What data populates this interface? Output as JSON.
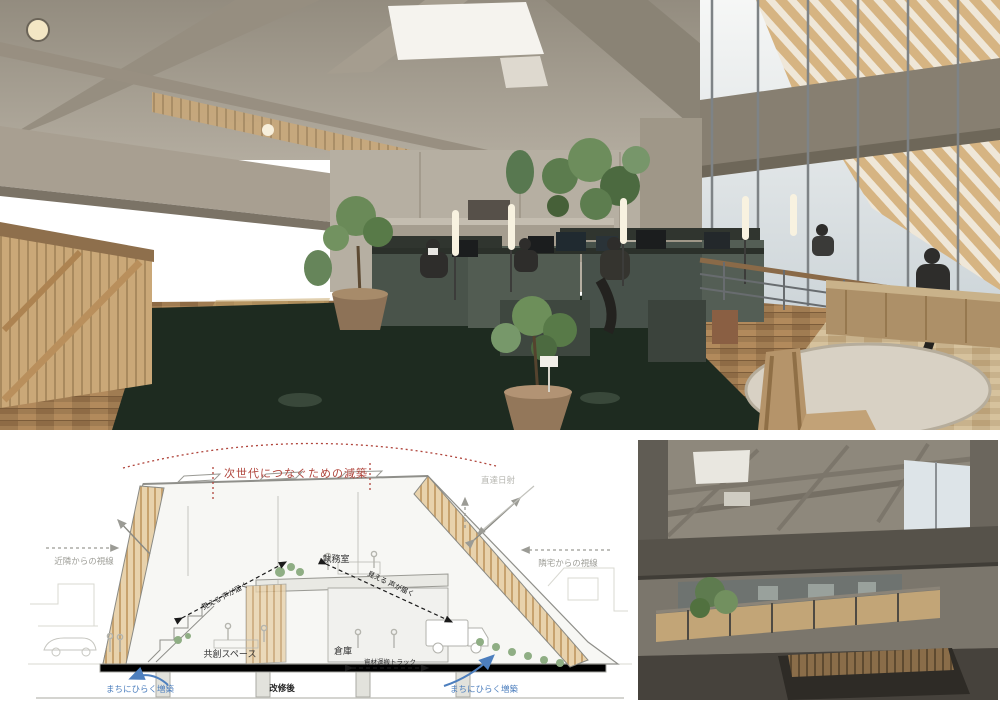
{
  "page": {
    "background": "#ffffff"
  },
  "photos": {
    "main": {
      "description": "Double-height concrete office atrium with timber roof, skylight, mezzanine, staff at desks on dark green carpet"
    },
    "secondary": {
      "description": "Concrete mezzanine walkway with wooden balustrade, skylight and corner windows"
    }
  },
  "diagram": {
    "labels": {
      "top_red": "次世代につなぐための減築",
      "direct_sunlight": "直達日射",
      "gaze_from_neighbors": "近隣からの視線",
      "gaze_from_adjacent_house": "隣宅からの視線",
      "office_room": "執務室",
      "co_creation_space": "共創スペース",
      "warehouse": "倉庫",
      "material_truck": "資材運搬トラック",
      "see_hear_left": "見える 声が届く",
      "see_hear_right": "見える 声が届く",
      "open_to_town_left": "まちにひらく増築",
      "open_to_town_right": "まちにひらく増築",
      "after_renovation": "改修後"
    },
    "colors": {
      "annotation_red": "#b0453c",
      "annotation_blue": "#4d7fbe",
      "annotation_gray": "#a0a09a",
      "wood": "#d9bb90",
      "plant_green": "#8fae84",
      "ink": "#333333"
    }
  }
}
